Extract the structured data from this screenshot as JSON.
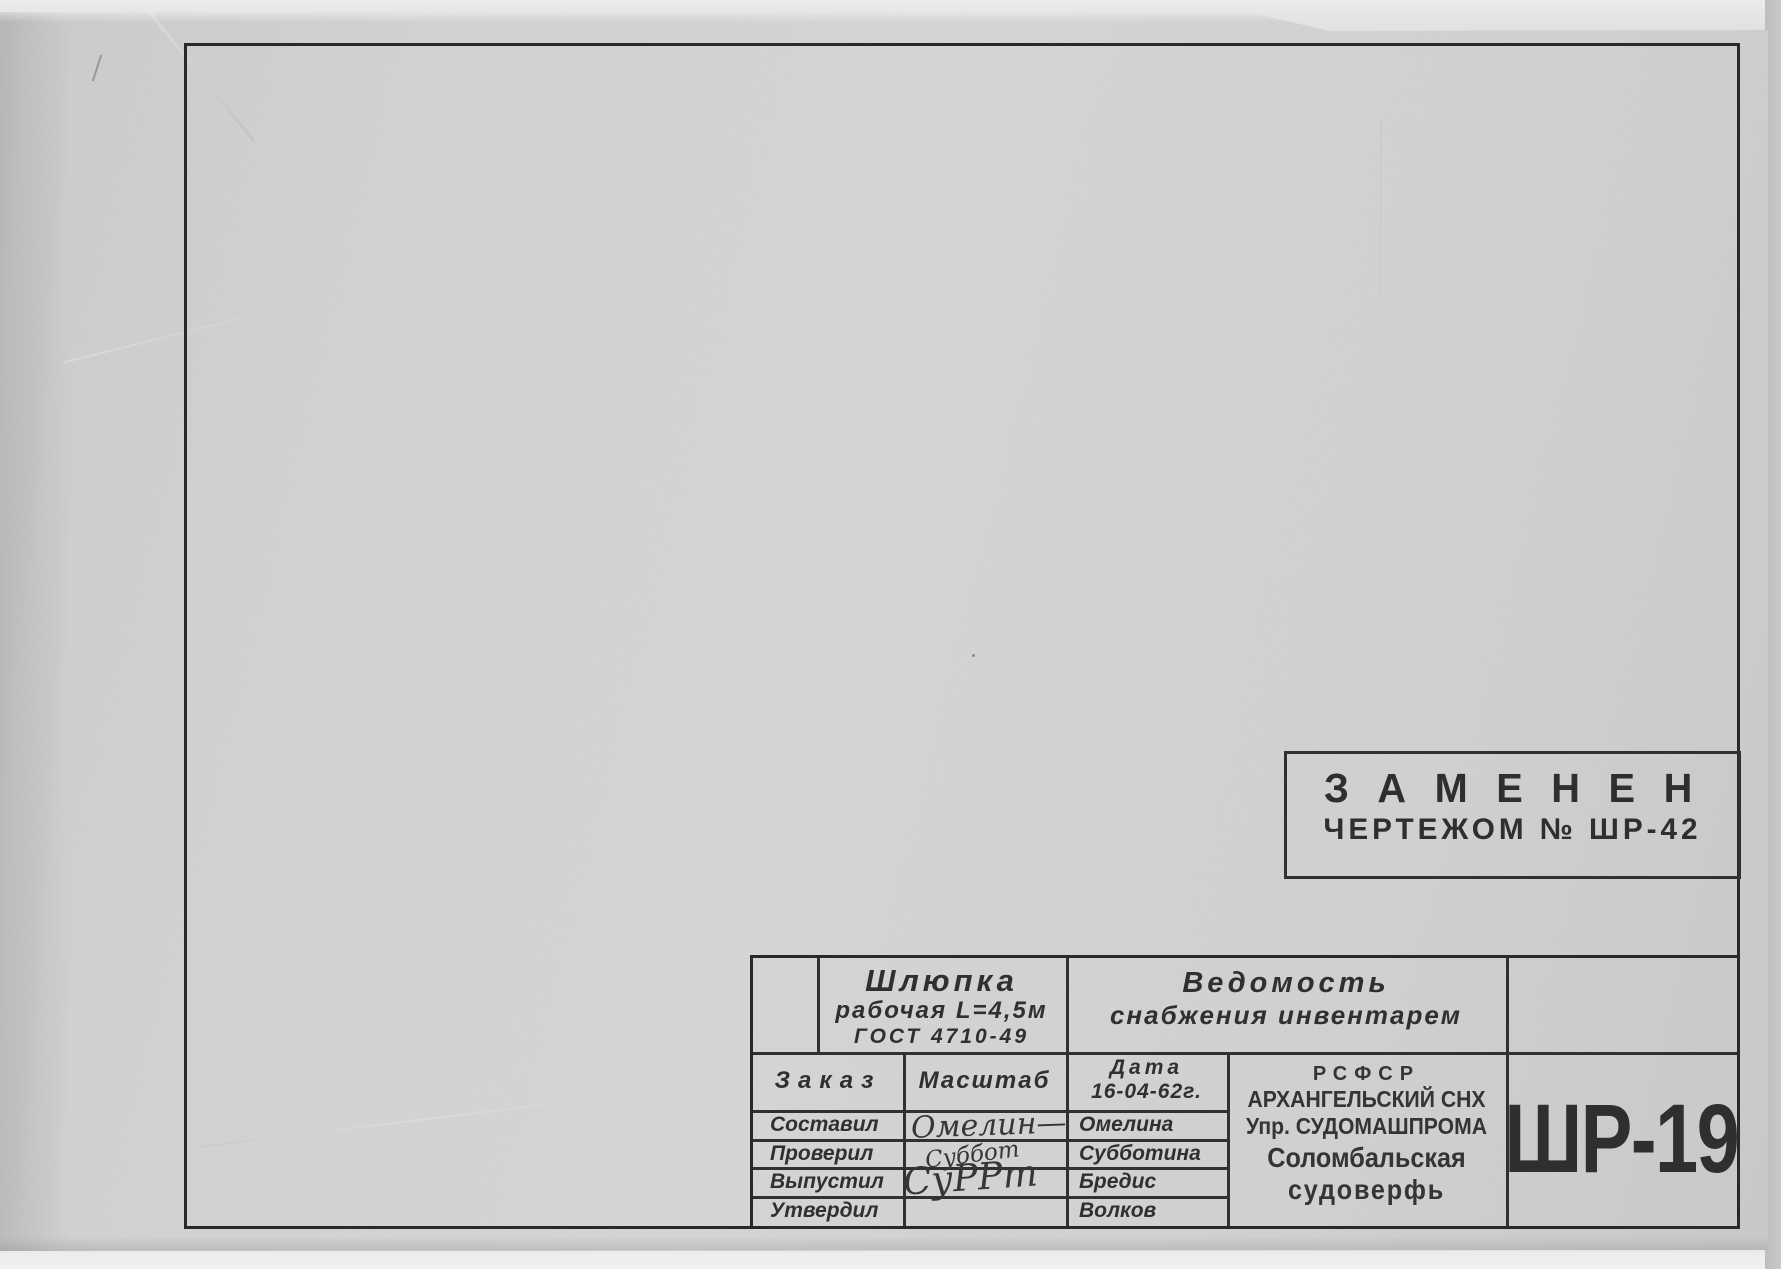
{
  "sheet": {
    "stamp": {
      "line1": "З А М Е Н Е Н",
      "line2": "ЧЕРТЕЖОМ № ШР-42"
    },
    "title_block": {
      "item_name": "Шлюпка",
      "item_spec": "рабочая L=4,5м",
      "item_gost": "ГОСТ 4710-49",
      "doc_title_line1": "Ведомость",
      "doc_title_line2": "снабжения инвентарем",
      "order_label": "Заказ",
      "scale_label": "Масштаб",
      "date_label": "Дата",
      "date_value": "16-04-62г.",
      "approval_rows": [
        {
          "role": "Составил",
          "signature": "Омелин—",
          "name": "Омелина"
        },
        {
          "role": "Проверил",
          "signature": "Суббот",
          "name": "Субботина"
        },
        {
          "role": "Выпустил",
          "signature": "СуРРт",
          "name": "Бредис"
        },
        {
          "role": "Утвердил",
          "signature": "",
          "name": "Волков"
        }
      ],
      "org_line1": "РСФСР",
      "org_line2": "АРХАНГЕЛЬСКИЙ СНХ",
      "org_line3": "Упр. СУДОМАШПРОМА",
      "org_line4": "Соломбальская",
      "org_line5": "судоверфь",
      "drawing_number": "ШР-19"
    },
    "colors": {
      "paper": "#d3d3d3",
      "ink": "#2b2b2b",
      "frame_line": "#242424"
    }
  }
}
